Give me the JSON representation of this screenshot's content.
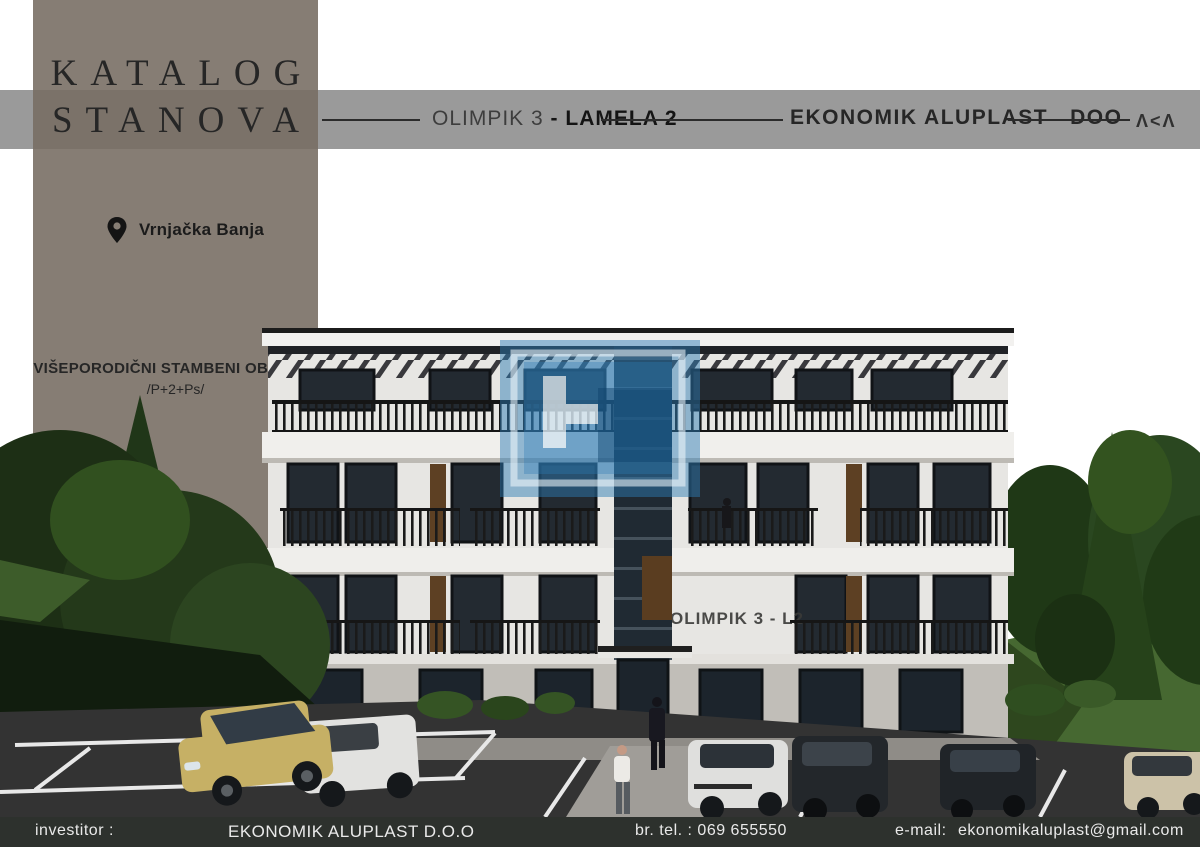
{
  "banner": {
    "title_line1": "KATALOG",
    "title_line2": "STANOVA",
    "location": "Vrnjačka Banja",
    "object_type": "VIŠEPORODIČNI STAMBENI OBJEKAT",
    "floors": "/P+2+Ps/"
  },
  "header": {
    "project": "OLIMPIK 3",
    "lamela": "- LAMELA 2",
    "company": "EKONOMIK ALUPLAST",
    "company_suffix": "DOO",
    "logo_mark": "Λ<Λ"
  },
  "render": {
    "building_sign": "OLIMPIK 3 - L2"
  },
  "footer": {
    "investor_label": "investitor :",
    "investor_value": "EKONOMIK ALUPLAST D.O.O",
    "phone": "br. tel. : 069 655550",
    "email_label": "e-mail:",
    "email_value": "ekonomikaluplast@gmail.com"
  },
  "icons": {
    "location_pin": "map-pin"
  },
  "colors": {
    "banner_bg": "#867d74",
    "band_bg": "#9a9a9a",
    "band_over_banner": "#7b7269",
    "footer_bg": "#2d312d",
    "watermark_blue": "#2e7cb5",
    "text_dark": "#262626",
    "footer_text": "#e9e9e9"
  }
}
